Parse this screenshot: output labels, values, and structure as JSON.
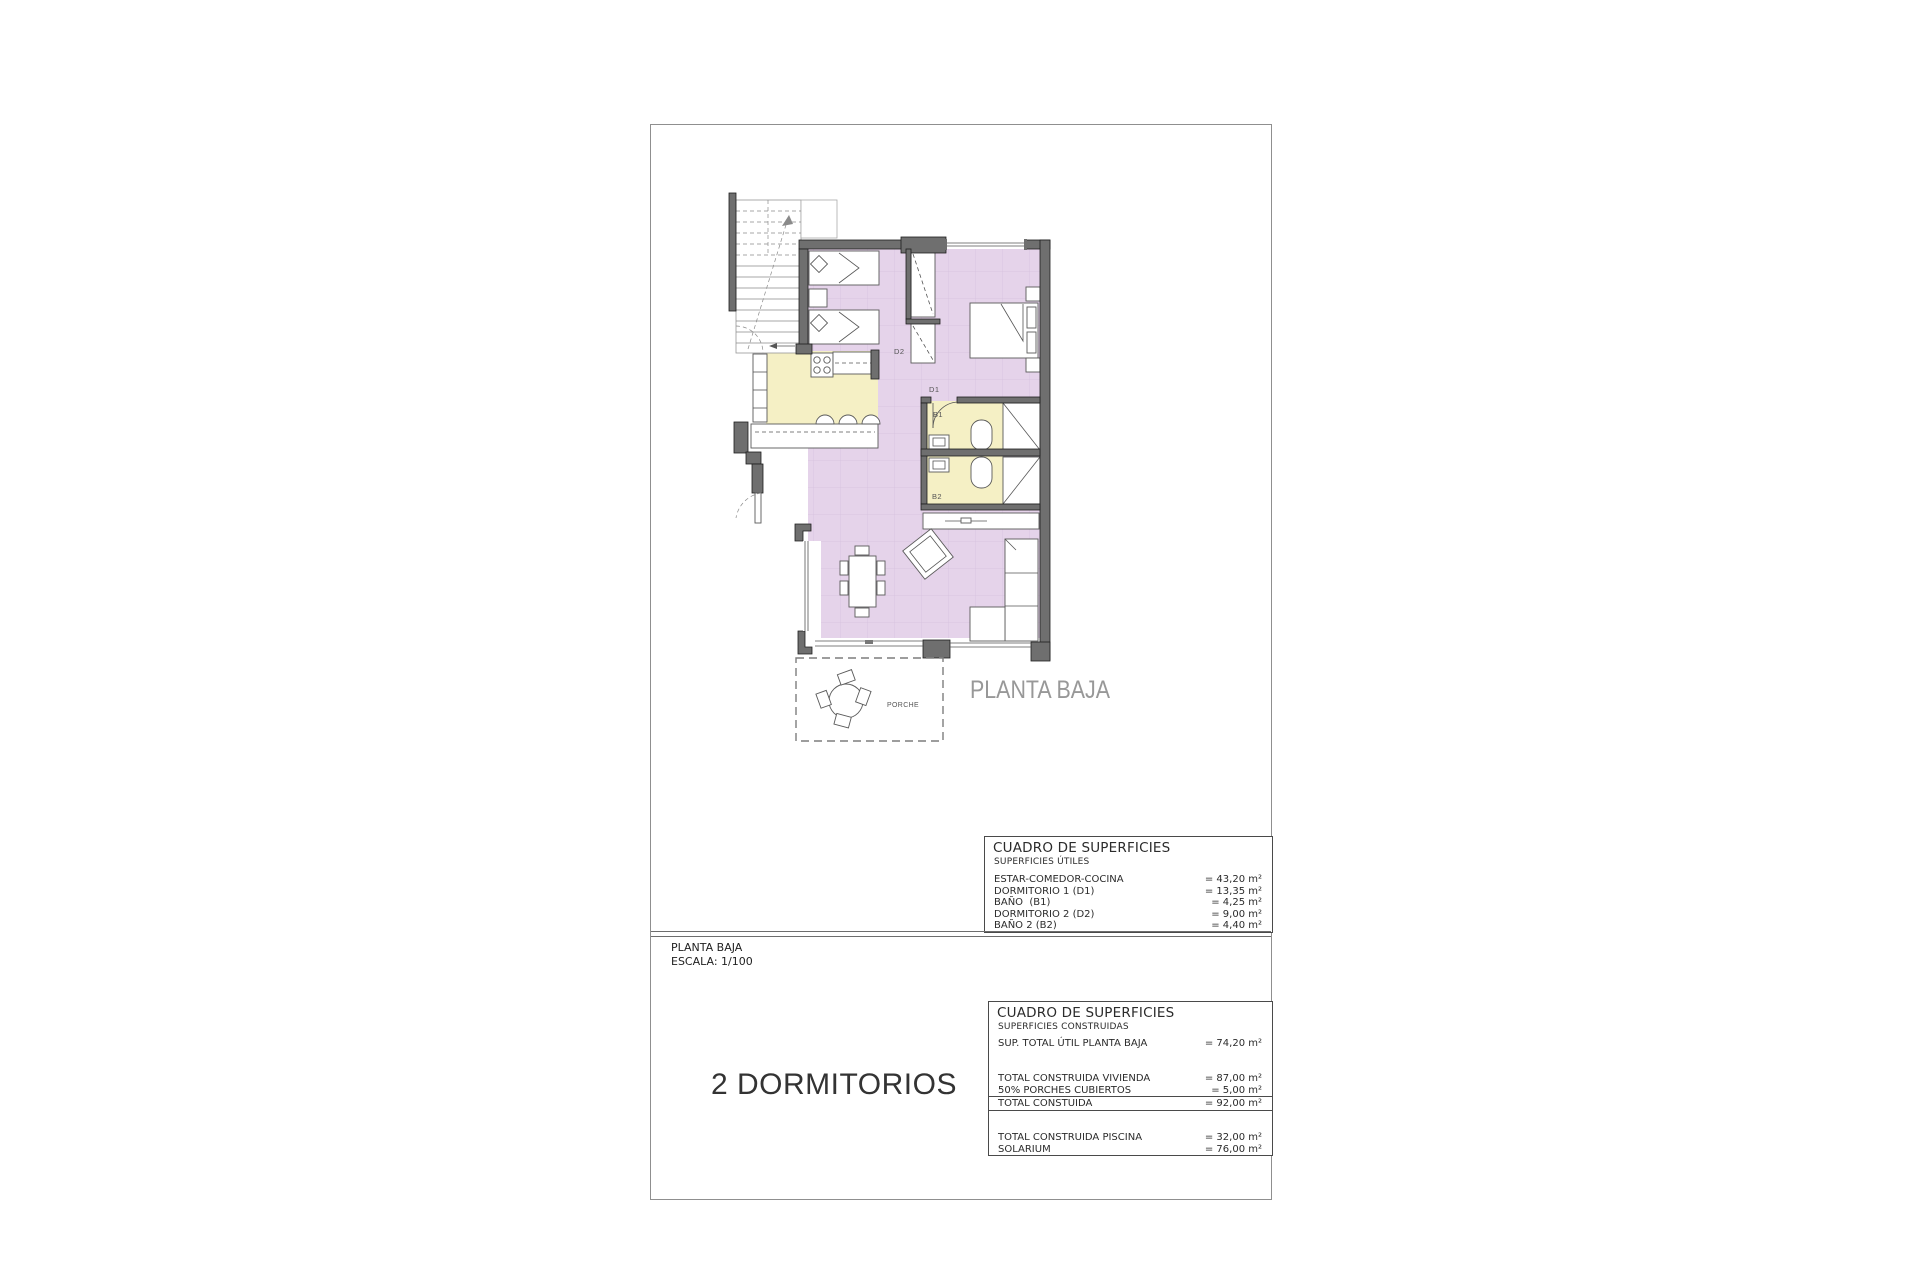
{
  "plan": {
    "title": "PLANTA BAJA",
    "rooms": {
      "d1": "D1",
      "d2": "D2",
      "b1": "B1",
      "b2": "B2",
      "porche": "PORCHE"
    },
    "colors": {
      "floor_main": "#e5d3ea",
      "floor_wet": "#f5f0c5",
      "wall": "#6f6f6f"
    }
  },
  "tables": {
    "utiles": {
      "title": "CUADRO DE SUPERFICIES",
      "subtitle": "SUPERFICIES ÚTILES",
      "rows": [
        {
          "label": "ESTAR-COMEDOR-COCINA",
          "value": "= 43,20 m²"
        },
        {
          "label": "DORMITORIO 1 (D1)",
          "value": "= 13,35 m²"
        },
        {
          "label": "BAÑO  (B1)",
          "value": "= 4,25 m²"
        },
        {
          "label": "DORMITORIO 2 (D2)",
          "value": "= 9,00 m²"
        },
        {
          "label": "BAÑO 2 (B2)",
          "value": "= 4,40 m²"
        }
      ]
    },
    "construidas": {
      "title": "CUADRO DE SUPERFICIES",
      "subtitle": "SUPERFICIES CONSTRUIDAS",
      "row_util": {
        "label": "SUP. TOTAL ÚTIL PLANTA BAJA",
        "value": "= 74,20 m²"
      },
      "rows_main": [
        {
          "label": "TOTAL CONSTRUIDA VIVIENDA",
          "value": "= 87,00 m²"
        },
        {
          "label": "50% PORCHES CUBIERTOS",
          "value": "= 5,00 m²"
        }
      ],
      "total": {
        "label": "TOTAL CONSTUIDA",
        "value": "= 92,00 m²"
      },
      "rows_extra": [
        {
          "label": "TOTAL CONSTRUIDA PISCINA",
          "value": "= 32,00 m²"
        },
        {
          "label": "SOLARIUM",
          "value": "= 76,00 m²"
        }
      ]
    }
  },
  "footer": {
    "plan_name": "PLANTA BAJA",
    "scale": "ESCALA: 1/100",
    "headline": "2 DORMITORIOS"
  }
}
